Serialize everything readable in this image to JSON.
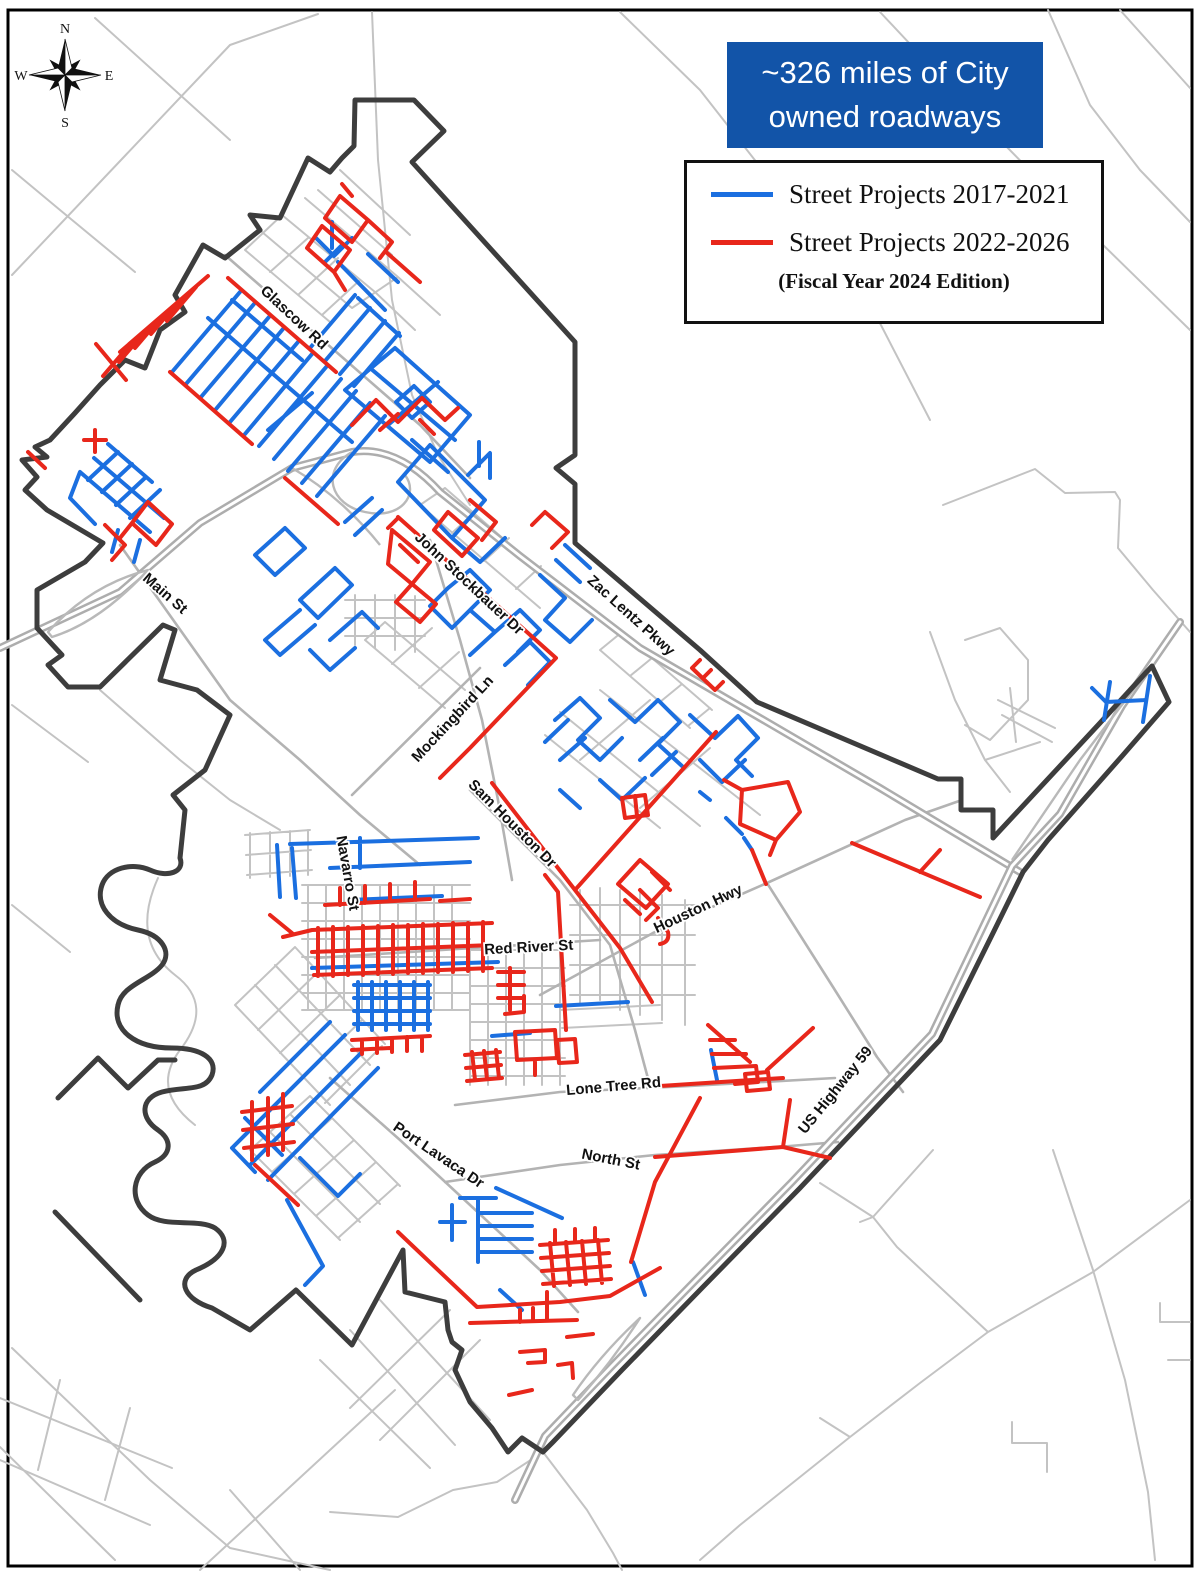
{
  "header": {
    "title_line1": "~326 miles of City",
    "title_line2": "owned roadways"
  },
  "legend": {
    "items": [
      {
        "label": "Street Projects 2017-2021",
        "color": "#1b6fe0"
      },
      {
        "label": "Street Projects 2022-2026",
        "color": "#e8271b"
      }
    ],
    "note": "(Fiscal Year 2024 Edition)"
  },
  "compass": {
    "north": "N",
    "east": "E",
    "south": "S",
    "west": "W"
  },
  "street_labels": [
    {
      "text": "Glascow Rd"
    },
    {
      "text": "Main St"
    },
    {
      "text": "John Stockbauer Dr"
    },
    {
      "text": "Zac Lentz Pkwy"
    },
    {
      "text": "Mockingbird Ln"
    },
    {
      "text": "Sam Houston Dr"
    },
    {
      "text": "Navarro St"
    },
    {
      "text": "Houston Hwy"
    },
    {
      "text": "Red River St"
    },
    {
      "text": "Lone Tree Rd"
    },
    {
      "text": "North St"
    },
    {
      "text": "Port Lavaca Dr"
    },
    {
      "text": "US Highway 59"
    }
  ],
  "colors": {
    "projects_2017_2021": "#1b6fe0",
    "projects_2022_2026": "#e8271b",
    "city_boundary": "#3d3d3d",
    "roads": "#c3c3c3",
    "highways": "#adadad",
    "title_background": "#1254a8",
    "title_text": "#ffffff"
  }
}
